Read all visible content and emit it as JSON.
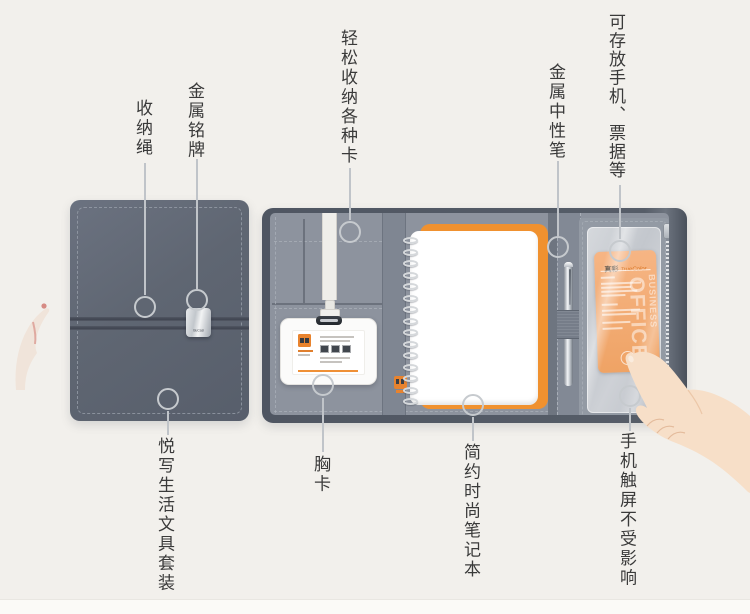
{
  "callouts": {
    "storage_rope": {
      "label": "收纳绳"
    },
    "metal_nameplate": {
      "label": "金属铭牌"
    },
    "easy_card_storage": {
      "label": "轻松收纳各种卡"
    },
    "metal_gel_pen": {
      "label": "金属中性笔"
    },
    "phone_pocket": {
      "label": "可存放手机、票据等"
    },
    "stationery_set": {
      "label": "悦写生活文具套装"
    },
    "chest_card": {
      "label": "胸卡"
    },
    "fashion_notebook": {
      "label": "简约时尚笔记本"
    },
    "touchscreen": {
      "label": "手机触屏不受影响"
    }
  },
  "product": {
    "nameplate_text": "BuCasi",
    "pocket_card": {
      "brand_cn": "真彩",
      "brand_en": "TrueColor",
      "watermark_top": "BUSINESS",
      "watermark_bottom": "OFFICE"
    }
  },
  "colors": {
    "background": "#f2f0ec",
    "cover_gray": "#5f6672",
    "panel_gray": "#8d939e",
    "accent_orange": "#ee8a30",
    "callout_line": "#c0c4c9",
    "label_text": "#3a3a3a"
  }
}
